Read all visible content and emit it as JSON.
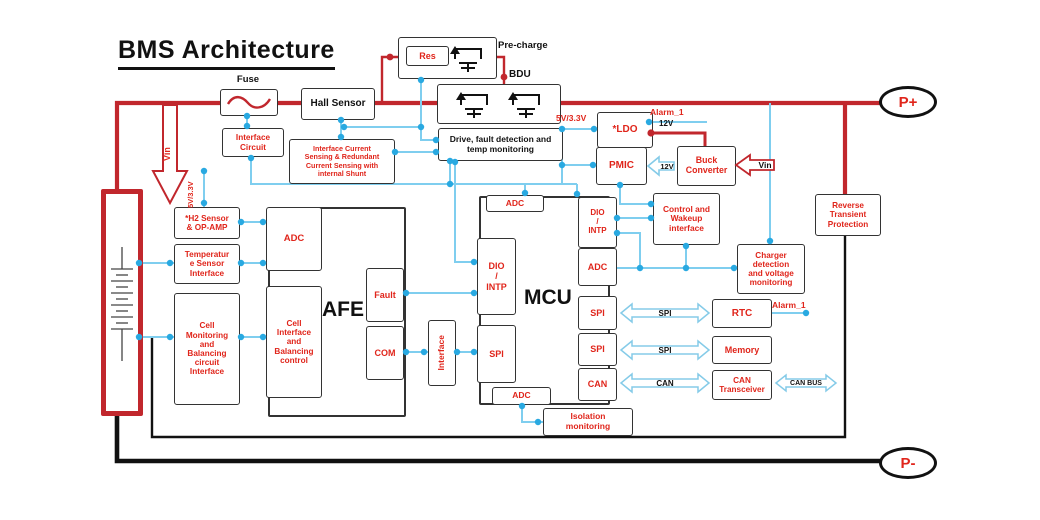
{
  "title": "BMS Architecture",
  "colors": {
    "power_red": "#C1272D",
    "label_red": "#E0251B",
    "wire_blue": "#7FCEEF",
    "node_blue": "#29A9E1",
    "ground_black": "#111111"
  },
  "terminals": {
    "positive": "P+",
    "negative": "P-"
  },
  "labels": {
    "fuse": "Fuse",
    "precharge": "Pre-charge",
    "bdu": "BDU",
    "alarm_top": "Alarm_1",
    "alarm_rtc": "Alarm_1",
    "v12_line": "12V",
    "v12_arrow": "12V",
    "v5_left": "5V/3.3V",
    "v5_right": "5V/3.3V",
    "vin_left": "Vin",
    "vin_right": "Vin"
  },
  "blocks": {
    "hall": "Hall Sensor",
    "res": "Res",
    "interface_circuit": "Interface\nCircuit",
    "current_sensing": "Interface Current\nSensing & Redundant\nCurrent Sensing with\ninternal Shunt",
    "drive": "Drive, fault detection and\ntemp monitoring",
    "ldo": "*LDO",
    "pmic": "PMIC",
    "buck": "Buck\nConverter",
    "control_wakeup": "Control and\nWakeup\ninterface",
    "charger": "Charger\ndetection\nand voltage\nmonitoring",
    "rtp": "Reverse\nTransient\nProtection",
    "rtc": "RTC",
    "memory": "Memory",
    "can_transceiver": "CAN\nTransceiver",
    "isolation": "Isolation\nmonitoring",
    "h2_sensor": "*H2 Sensor\n& OP-AMP",
    "temp_sensor": "Temperatur\ne Sensor\nInterface",
    "cell_monitoring": "Cell\nMonitoring\nand\nBalancing\ncircuit\nInterface",
    "interface_vertical": "Interface"
  },
  "afe": {
    "label": "AFE",
    "adc": "ADC",
    "cell_interface": "Cell\nInterface\nand\nBalancing\ncontrol",
    "fault": "Fault",
    "com": "COM"
  },
  "mcu": {
    "label": "MCU",
    "adc_top": "ADC",
    "adc_bottom": "ADC",
    "dio_left": "DIO\n/\nINTP",
    "spi_left": "SPI",
    "dio_right": "DIO\n/\nINTP",
    "adc_right": "ADC",
    "spi_right1": "SPI",
    "spi_right2": "SPI",
    "can_right": "CAN"
  },
  "buses": {
    "spi1": "SPI",
    "spi2": "SPI",
    "can": "CAN",
    "can_bus": "CAN BUS"
  }
}
